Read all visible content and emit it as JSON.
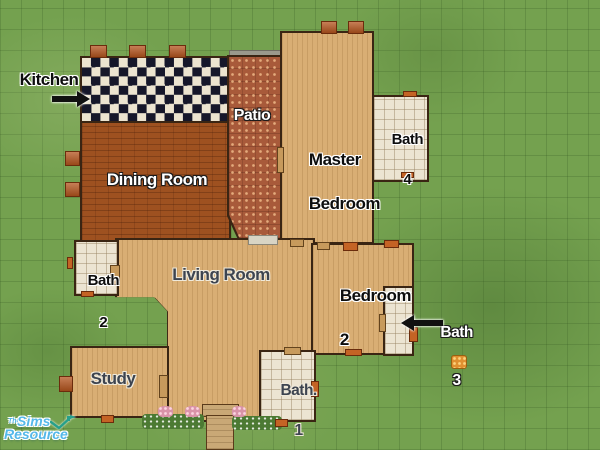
{
  "rooms": {
    "kitchen": {
      "label": "Kitchen"
    },
    "patio": {
      "label": "Patio"
    },
    "dining_room": {
      "label": "Dining Room"
    },
    "master_bedroom": {
      "line1": "Master",
      "line2": "Bedroom"
    },
    "bath4": {
      "line1": "Bath",
      "line2": "4"
    },
    "bath2": {
      "line1": "Bath",
      "line2": "2"
    },
    "living_room": {
      "label": "Living Room"
    },
    "bedroom2": {
      "line1": "Bedroom",
      "line2": "2"
    },
    "bath3": {
      "line1": "Bath",
      "line2": "3"
    },
    "study": {
      "label": "Study"
    },
    "bath1": {
      "line1": "Bath.",
      "line2": "1"
    }
  },
  "annotations": {
    "kitchen_arrow_direction": "right",
    "bath3_arrow_direction": "left"
  },
  "watermark": {
    "the": "The",
    "sims": "Sims",
    "resource": "Resource"
  },
  "colors": {
    "grass": "#74a14f",
    "wall": "#3a2513",
    "tan_floor": "#d9ae74",
    "dining_floor": "#9e5120",
    "patio_floor": "#a85a3a",
    "tile_floor": "#ece4d2",
    "checker_dark": "#16172a",
    "checker_light": "#ece4d0",
    "label_black": "#0d0d0d",
    "label_white": "#ffffff",
    "label_slate": "#3d4450",
    "watermark_blue": "#54b8ea",
    "watermark_teal": "#27a08b"
  }
}
